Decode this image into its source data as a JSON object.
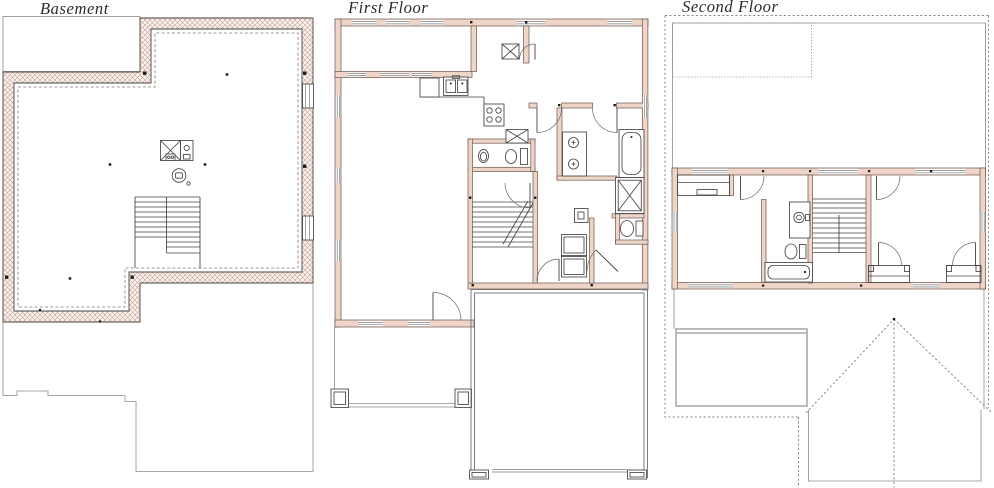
{
  "sheet": {
    "width": 994,
    "height": 488,
    "background": "#ffffff"
  },
  "panels": [
    {
      "id": "basement",
      "title": "Basement"
    },
    {
      "id": "first-floor",
      "title": "First Floor"
    },
    {
      "id": "second-floor",
      "title": "Second Floor"
    }
  ],
  "colors": {
    "title_color": "#2e2a28",
    "line": "#474340",
    "thin_line": "#8f8c89",
    "dashed_line": "#7e7b78",
    "wall_fill": "#eed5c8",
    "wall_stroke": "#6b554b",
    "hatch_line": "#c99d8f",
    "hatch_bg": "#faf4f0",
    "roof_gray": "#a8a8a8"
  },
  "fixtures": {
    "basement": [
      "furnace",
      "water-heater",
      "floor-drain",
      "stairs"
    ],
    "first_floor": [
      "kitchen-sink",
      "range",
      "dishwasher",
      "powder-sink",
      "toilet",
      "double-vanity",
      "bathtub",
      "shower",
      "toilet",
      "washer",
      "dryer",
      "stairs",
      "porch-columns",
      "garage-door"
    ],
    "second_floor": [
      "vanity-sink",
      "toilet",
      "bathtub",
      "stairs",
      "closets"
    ]
  }
}
